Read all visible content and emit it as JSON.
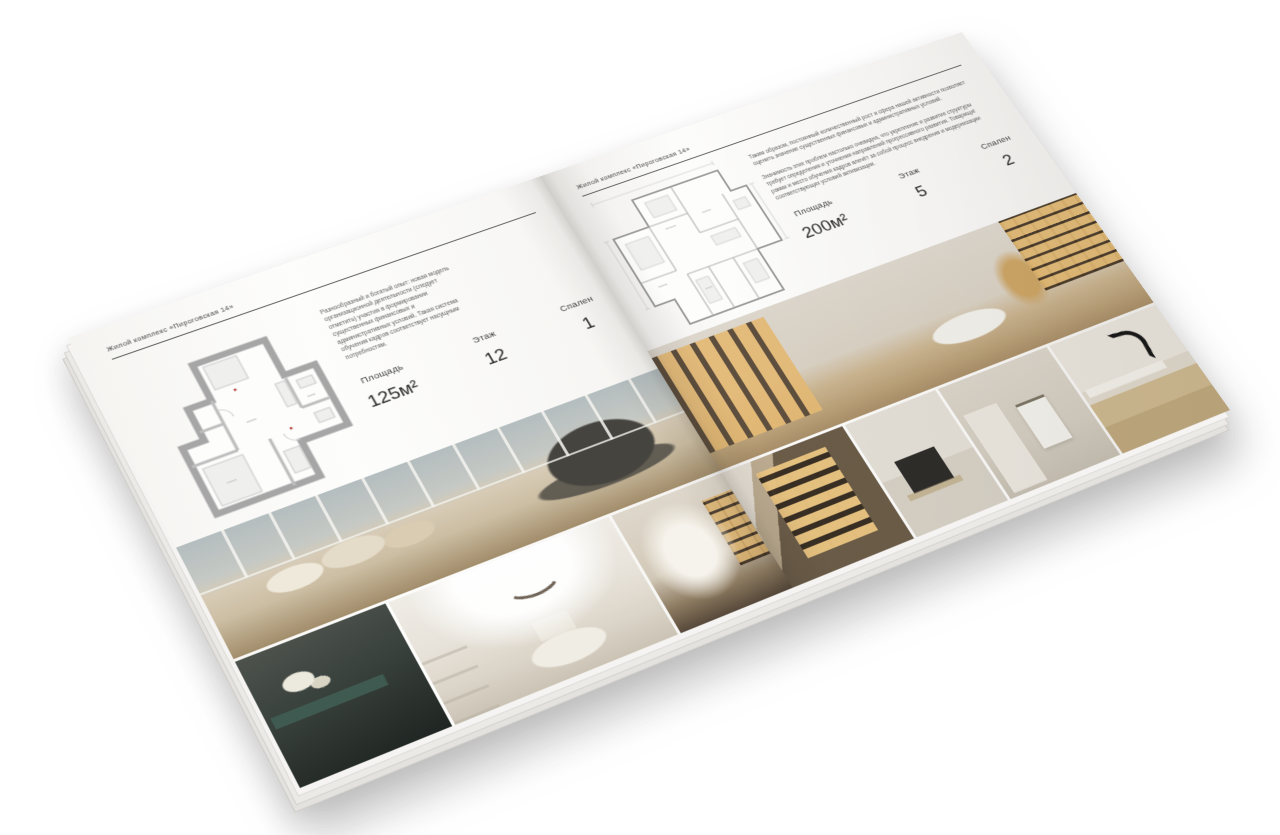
{
  "palette": {
    "background": "#ffffff",
    "paper": "#fbfbfa",
    "text_dark": "#3e3e3e",
    "text_body": "#5f5f5f",
    "rule": "#4b4b4b",
    "plan_wall_thick": "#a6a6a6",
    "plan_wall_thin": "#9b9b9b",
    "plan_accent_red": "#b5443c",
    "photo_warm_beige": "#cfc2ad",
    "photo_window_gray": "#b4bdbf",
    "photo_dark_teal": "#3a423e",
    "photo_amber_glow": "#e0b56e",
    "photo_wood": "#6b5c48",
    "photo_marble": "#e8e3da",
    "photo_faucet_black": "#191919",
    "shadow": "rgba(70,70,70,0.28)"
  },
  "brochure": {
    "left_page": {
      "header": "Жилой комплекс «Пироговская 14»",
      "description": "Разнообразный и богатый опыт: новая модель организационной деятельности (следует отметить) участия в формировании существенных финансовых и административных условий. Такая система обучения кадров соответствует насущным потребностям.",
      "specs": [
        {
          "label": "Площадь",
          "value": "125м²"
        },
        {
          "label": "Этаж",
          "value": "12"
        },
        {
          "label": "Спален",
          "value": "1"
        }
      ],
      "photos": [
        "bedroom-with-panoramic-window",
        "dark-console-with-flowers",
        "white-arched-bedroom",
        "arched-corridor-with-display-shelves"
      ]
    },
    "right_page": {
      "header": "Жилой комплекс «Пироговская 14»",
      "description_1": "Таким образом, постоянный количественный рост и сфера нашей активности позволяет оценить значение существенных финансовых и административных условий.",
      "description_2": "Значимость этих проблем настолько очевидна, что укрепление и развитие структуры требует определения и уточнения направлений прогрессивного развития. Товарищи! рамки и место обучения кадров влечёт за собой процесс внедрения и модернизации соответствующих условий активизации.",
      "specs": [
        {
          "label": "Площадь",
          "value": "200м²"
        },
        {
          "label": "Этаж",
          "value": "5"
        },
        {
          "label": "Спален",
          "value": "2"
        }
      ],
      "photos": [
        "dressing-room-with-lit-wardrobes",
        "lit-display-cabinet",
        "kitchen-niche-dark-appliance",
        "bathroom-with-towel-rail",
        "marble-vanity-black-faucet"
      ]
    }
  }
}
